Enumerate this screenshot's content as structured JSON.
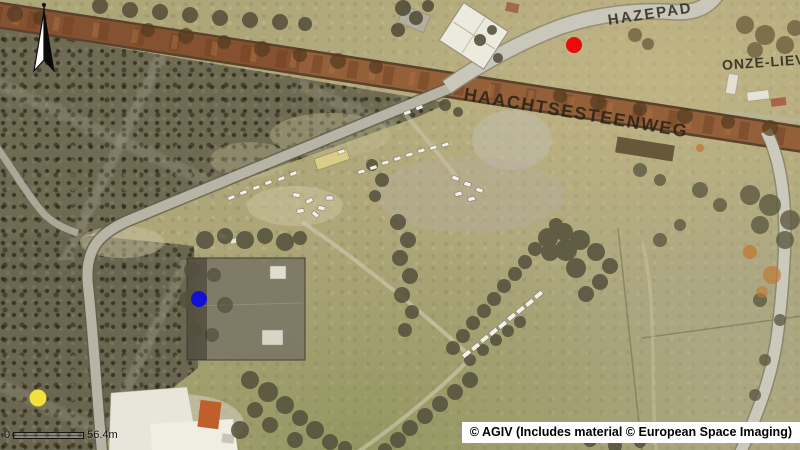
{
  "map": {
    "street_labels": {
      "hazepad": "HAZEPAD",
      "haachtsesteenweg": "HAACHTSESTEENWEG",
      "onze_lieve": "ONZE-LIEV"
    },
    "markers": [
      {
        "name": "red-marker",
        "color": "#ea0c0c"
      },
      {
        "name": "blue-marker",
        "color": "#1410d2"
      },
      {
        "name": "yellow-marker",
        "color": "#f1e13c"
      }
    ],
    "scale_bar": {
      "start": "0",
      "end": "56.4m"
    },
    "attribution": "© AGIV (Includes material © European Space Imaging)"
  }
}
